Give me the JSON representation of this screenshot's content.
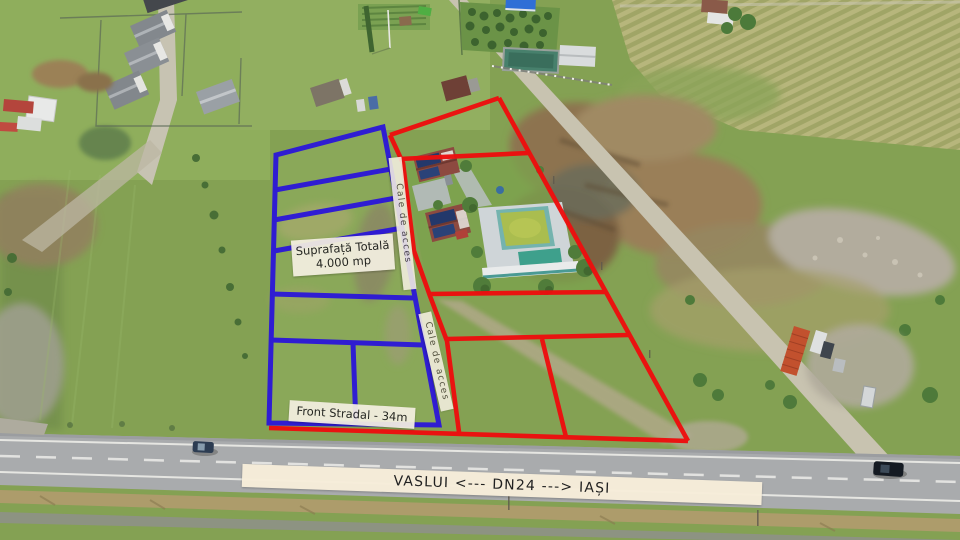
{
  "annotations": {
    "total_area": {
      "line1": "Suprafață Totală",
      "line2": "4.000 mp"
    },
    "street_front": "Front Stradal - 34m",
    "access_1": "Cale de acces",
    "access_2": "Cale de acces",
    "road_banner": "VASLUI <--- DN24 ---> IAȘI"
  },
  "colors": {
    "parcel_blue": "#2b16d9",
    "parcel_red": "#ee0e0e",
    "label_bg": "#f4efe1",
    "banner_bg": "#f7eeda",
    "label_text": "#1c1c1c"
  }
}
